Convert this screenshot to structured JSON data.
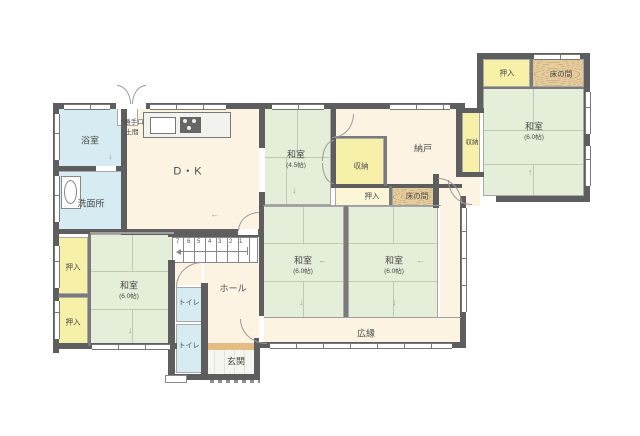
{
  "title": "1F間取り図",
  "labels": {
    "bath": "浴室",
    "washroom": "洗面所",
    "dk": "D・K",
    "kitchen_door_line1": "勝手口",
    "kitchen_door_line2": "土間",
    "washitsu45": "和室",
    "washitsu45_size": "(4.5帖)",
    "closet_mid": "収納",
    "nando": "納戸",
    "closet_right": "収納",
    "oshiire_mid": "押入",
    "tokonoma_mid": "床の間",
    "tr_oshiire": "押入",
    "tr_tokonoma": "床の間",
    "tr_washitsu": "和室",
    "tr_washitsu_size": "(6.0帖)",
    "center_left_washitsu": "和室",
    "center_left_size": "(6.0帖)",
    "center_right_washitsu": "和室",
    "center_right_size": "(6.0帖)",
    "hiroen": "広縁",
    "bl_oshiire_upper": "押入",
    "bl_oshiire_lower": "押入",
    "bl_washitsu": "和室",
    "bl_washitsu_size": "(6.0帖)",
    "toilet_upper": "トイレ",
    "toilet_lower": "トイレ",
    "hall": "ホール",
    "genkan": "玄関"
  },
  "stairs": {
    "numbers": [
      "7",
      "6",
      "5",
      "4",
      "3",
      "2",
      "1"
    ]
  },
  "colors": {
    "tatami_green": "#e4eed8",
    "water_blue": "#d7ecf2",
    "closet_yellow": "#f6f0a8",
    "oshiire_pale_yellow": "#fbf7d6",
    "wood_tan": "#e5cc9c",
    "floor_cream": "#fdf3e2",
    "wall_gray": "#5e5e5e",
    "entry_step_tan": "#e5bd84"
  }
}
